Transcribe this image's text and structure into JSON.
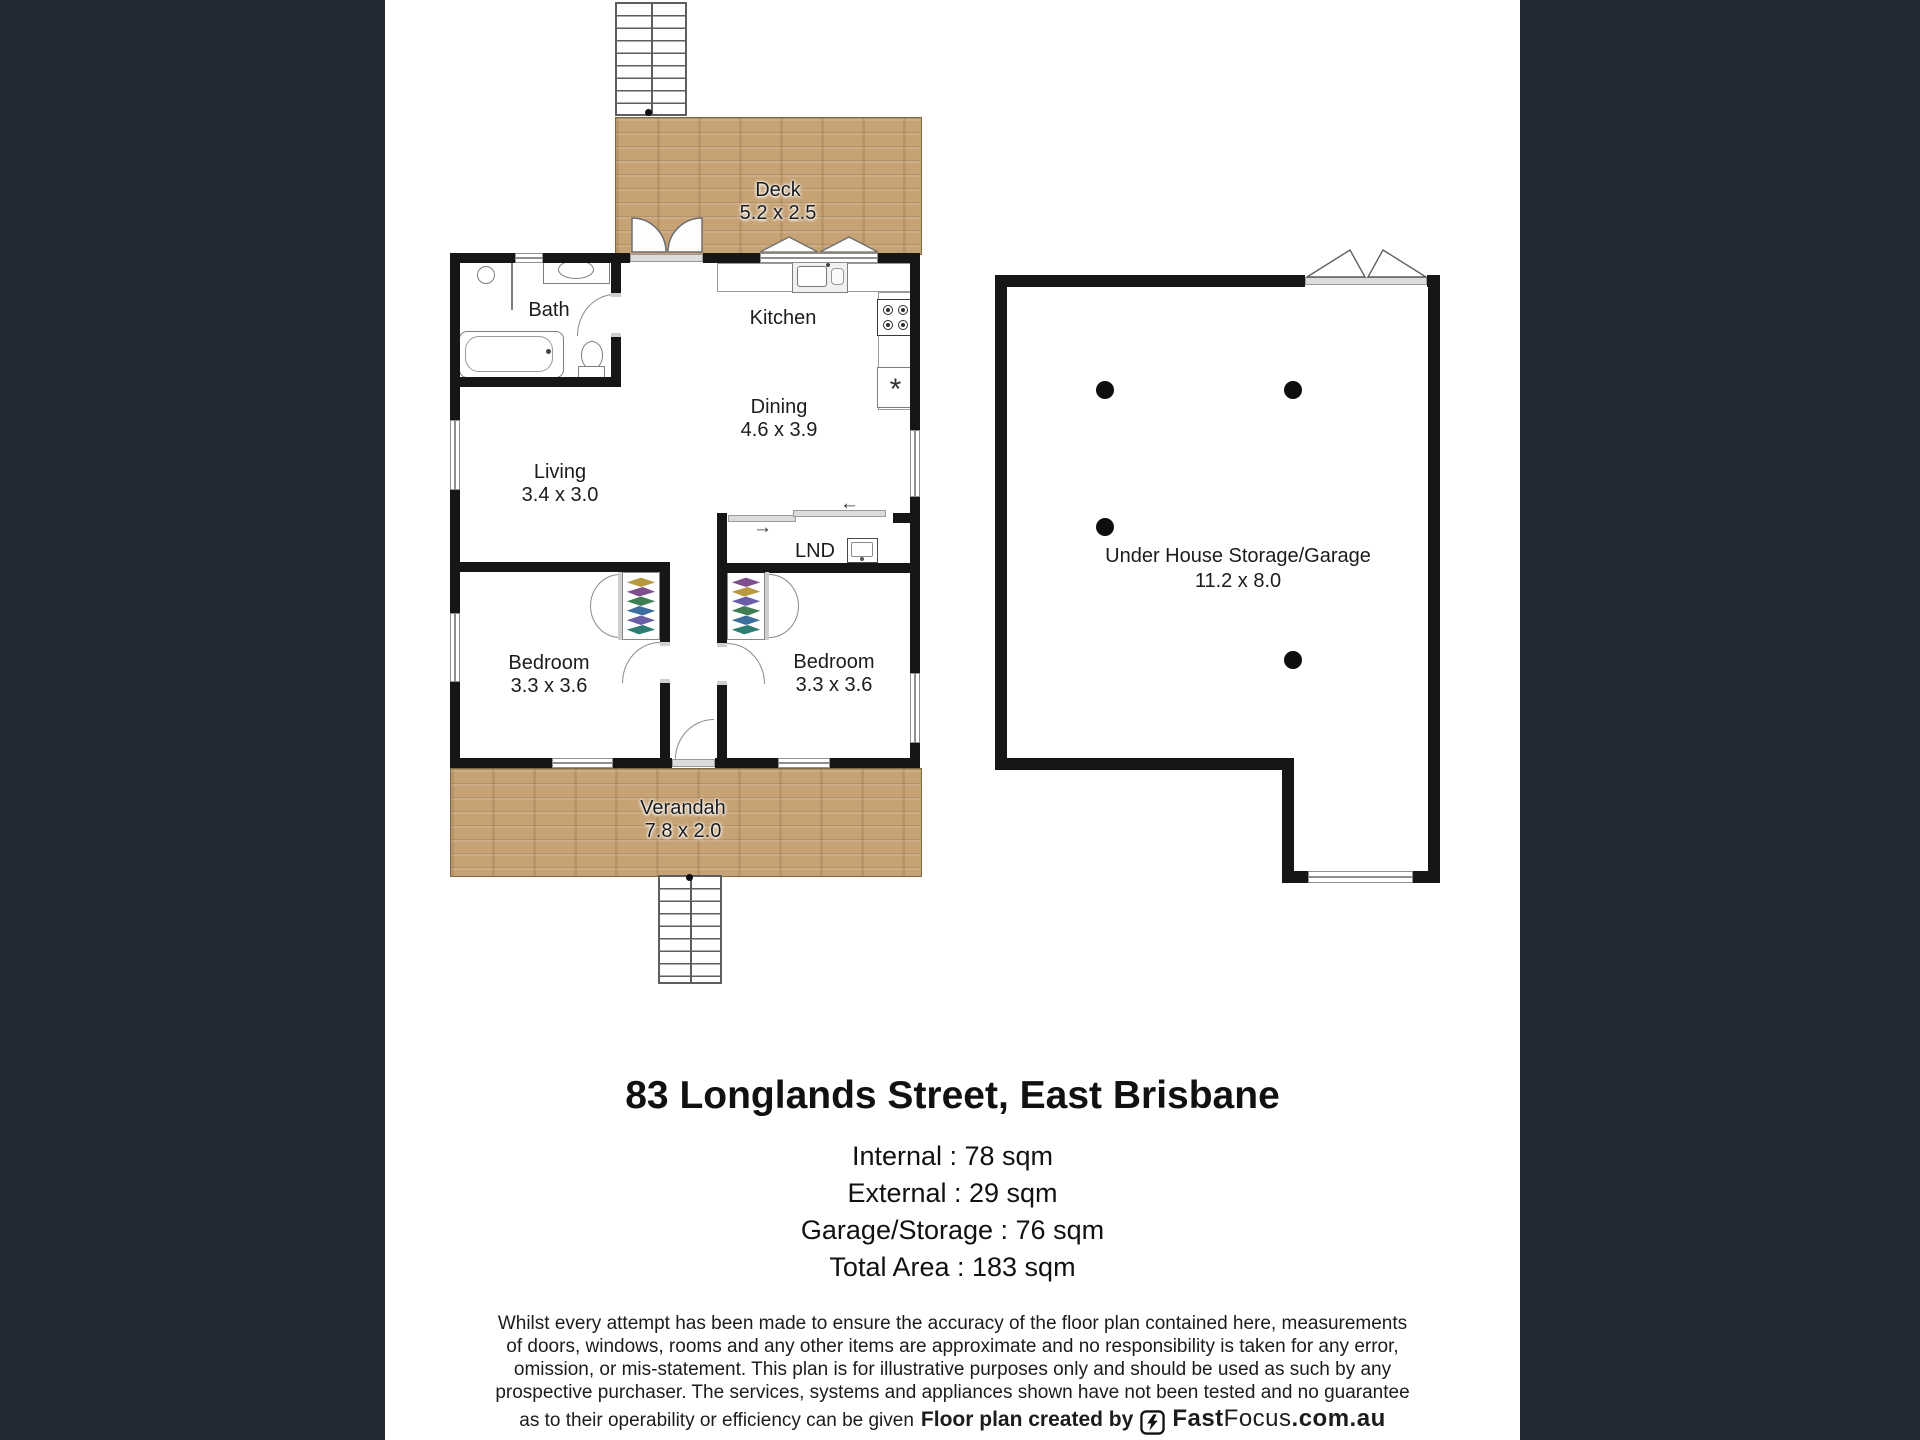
{
  "colors": {
    "page_bg": "#222b34",
    "paper_bg": "#ffffff",
    "wall": "#161616",
    "wood": "#c6a274",
    "window_frame": "#8f8f8f"
  },
  "plan": {
    "rooms": {
      "deck": {
        "label": "Deck",
        "dims": "5.2 x 2.5"
      },
      "bath": {
        "label": "Bath"
      },
      "kitchen": {
        "label": "Kitchen"
      },
      "dining": {
        "label": "Dining",
        "dims": "4.6 x 3.9"
      },
      "living": {
        "label": "Living",
        "dims": "3.4 x 3.0"
      },
      "laundry": {
        "label": "LND"
      },
      "bedroom1": {
        "label": "Bedroom",
        "dims": "3.3 x 3.6"
      },
      "bedroom2": {
        "label": "Bedroom",
        "dims": "3.3 x 3.6"
      },
      "verandah": {
        "label": "Verandah",
        "dims": "7.8 x 2.0"
      },
      "garage": {
        "label": "Under House Storage/Garage",
        "dims": "11.2 x 8.0"
      }
    },
    "fridge_symbol": "*",
    "slider_arrows": {
      "left": "←",
      "right": "→"
    }
  },
  "summary": {
    "title": "83 Longlands Street, East Brisbane",
    "areas": [
      "Internal : 78 sqm",
      "External : 29 sqm",
      "Garage/Storage : 76 sqm",
      "Total Area : 183 sqm"
    ]
  },
  "disclaimer": {
    "lines": [
      "Whilst every attempt has been made to ensure the accuracy of the floor plan contained here, measurements",
      "of doors, windows, rooms and any other items are approximate and no responsibility is taken for any error,",
      "omission, or mis-statement. This plan is for illustrative purposes only and should be used as such by any",
      "prospective purchaser. The services, systems and appliances shown have not been tested and no guarantee",
      "as to their operability or efficiency can be given"
    ],
    "credit": "Floor plan created by",
    "brand": {
      "bold": "Fast",
      "light": "Focus",
      "suffix": ".com.au"
    }
  }
}
